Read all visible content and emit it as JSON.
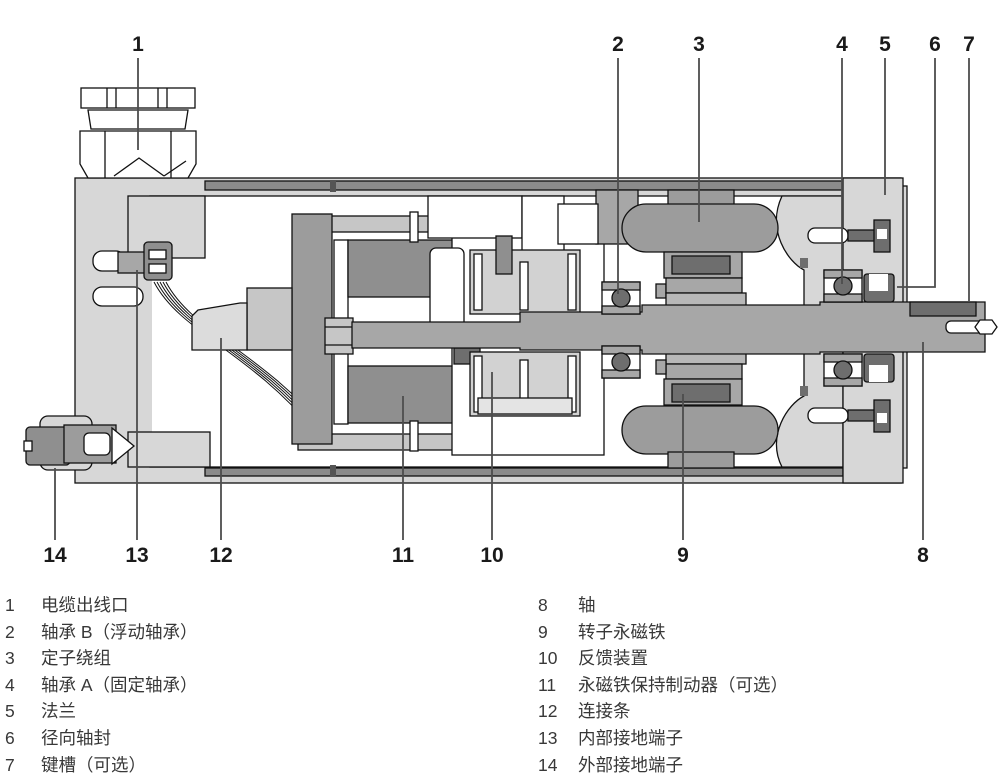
{
  "title": "servo-motor-cross-section-diagram",
  "colors": {
    "housing": "#d7d7d7",
    "part_light": "#dcdcdc",
    "part_mount": "#c6c6c6",
    "part_mid": "#a7a7a7",
    "part_gray": "#9c9c9c",
    "part_deep": "#8f8f8f",
    "part_dark": "#6e6e6e",
    "liner": "#8b8b8b",
    "outline": "#111111",
    "leader_line": "#4d4d4d",
    "label_text": "#1a1a1a",
    "legend_text": "#383838"
  },
  "callouts": {
    "top": [
      {
        "num": "1"
      },
      {
        "num": "2"
      },
      {
        "num": "3"
      },
      {
        "num": "4"
      },
      {
        "num": "5"
      },
      {
        "num": "6"
      },
      {
        "num": "7"
      }
    ],
    "bottom": [
      {
        "num": "14"
      },
      {
        "num": "13"
      },
      {
        "num": "12"
      },
      {
        "num": "11"
      },
      {
        "num": "10"
      },
      {
        "num": "9"
      },
      {
        "num": "8"
      }
    ]
  },
  "legend": {
    "left": [
      {
        "num": "1",
        "label": "电缆出线口"
      },
      {
        "num": "2",
        "label": "轴承 B（浮动轴承）"
      },
      {
        "num": "3",
        "label": "定子绕组"
      },
      {
        "num": "4",
        "label": "轴承 A（固定轴承）"
      },
      {
        "num": "5",
        "label": "法兰"
      },
      {
        "num": "6",
        "label": "径向轴封"
      },
      {
        "num": "7",
        "label": "键槽（可选）"
      }
    ],
    "right": [
      {
        "num": "8",
        "label": "轴"
      },
      {
        "num": "9",
        "label": "转子永磁铁"
      },
      {
        "num": "10",
        "label": "反馈装置"
      },
      {
        "num": "11",
        "label": "永磁铁保持制动器（可选）"
      },
      {
        "num": "12",
        "label": "连接条"
      },
      {
        "num": "13",
        "label": "内部接地端子"
      },
      {
        "num": "14",
        "label": "外部接地端子"
      }
    ]
  }
}
